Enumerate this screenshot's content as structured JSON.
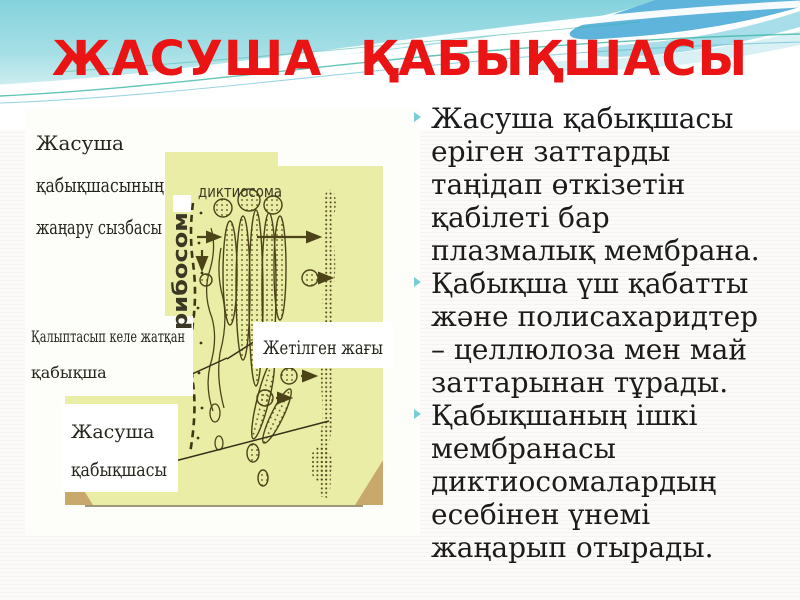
{
  "slide": {
    "title": "ЖАСУША ҚАБЫҚШАСЫ"
  },
  "colors": {
    "title_red": "#ea1414",
    "bullet_marker_cyan": "#79cdd6",
    "wave_cyan": "#8bd4dd",
    "wave_blue_band": "#5fb4dc",
    "diagram_yellow": "#e9eda5",
    "diagram_ink": "#4c4418",
    "diagram_corner_tan": "#c9a86b"
  },
  "diagram": {
    "caption_lines": [
      "Жасуша",
      "қабықшасының",
      "жаңару сызбасы"
    ],
    "labels": {
      "dictyosome": "диктиосома",
      "ribosome": "рибосом",
      "forming_line1": "Қалыптасып келе жатқан",
      "forming_line2": "қабықша",
      "mature_side": "Жетілген жағы",
      "membrane_line1": "Жасуша",
      "membrane_line2": "қабықшасы"
    }
  },
  "bullets": [
    {
      "lines": [
        "Жасуша қабықшасы",
        "еріген заттарды",
        "таңідап өткізетін",
        "қабілеті бар",
        "плазмалық мембрана."
      ]
    },
    {
      "lines": [
        "Қабықша үш қабатты",
        "және полисахаридтер",
        "– целлюлоза мен май",
        "заттарынан тұрады."
      ]
    },
    {
      "lines": [
        "Қабықшаның ішкі",
        "мембранасы",
        "диктиосомалардың",
        "есебінен үнемі",
        "жаңарып отырады."
      ]
    }
  ]
}
